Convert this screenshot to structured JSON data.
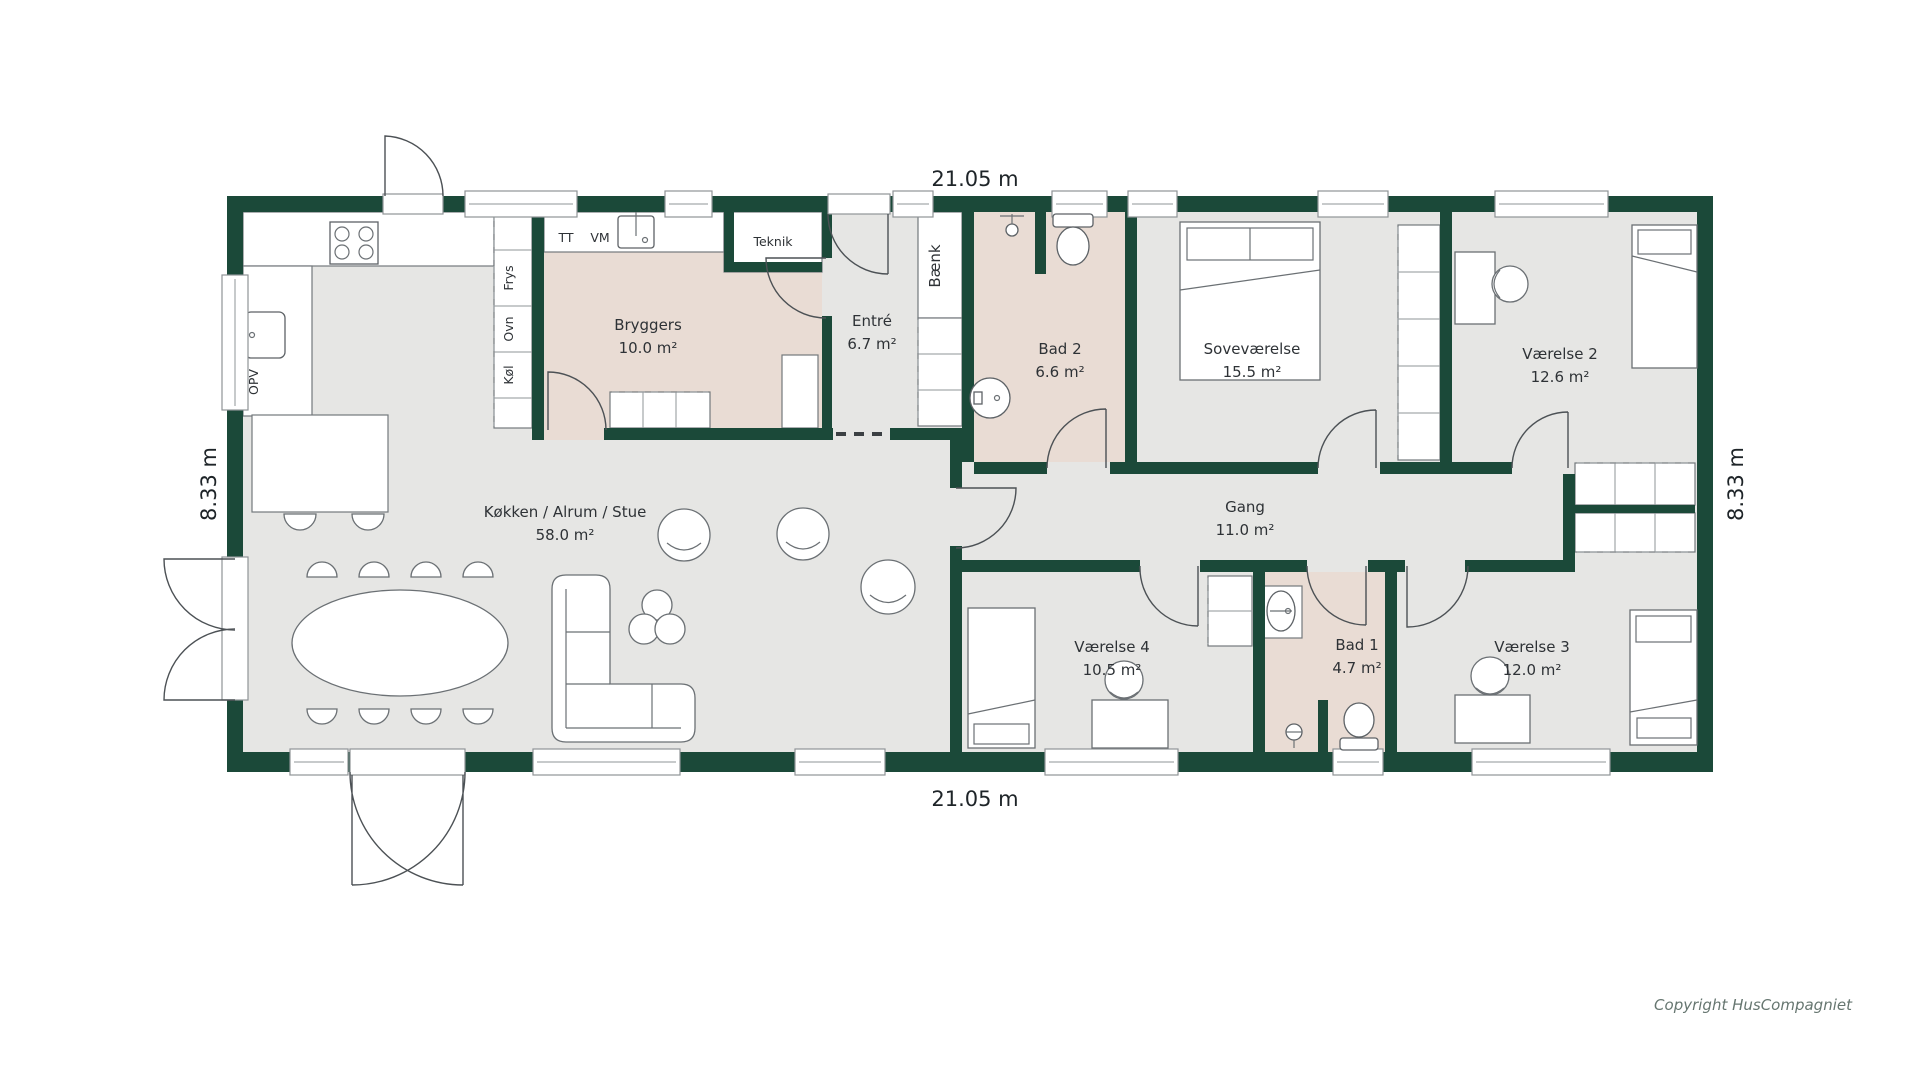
{
  "plan": {
    "dimensions": {
      "top": "21.05 m",
      "bottom": "21.05 m",
      "left": "8.33 m",
      "right": "8.33 m"
    },
    "rooms": [
      {
        "id": "bryggers",
        "name": "Bryggers",
        "area": "10.0 m²"
      },
      {
        "id": "entre",
        "name": "Entré",
        "area": "6.7 m²"
      },
      {
        "id": "bad2",
        "name": "Bad 2",
        "area": "6.6 m²"
      },
      {
        "id": "sovevaerelse",
        "name": "Soveværelse",
        "area": "15.5 m²"
      },
      {
        "id": "vaerelse2",
        "name": "Værelse 2",
        "area": "12.6 m²"
      },
      {
        "id": "stue",
        "name": "Køkken / Alrum / Stue",
        "area": "58.0 m²"
      },
      {
        "id": "gang",
        "name": "Gang",
        "area": "11.0 m²"
      },
      {
        "id": "vaerelse4",
        "name": "Værelse 4",
        "area": "10.5 m²"
      },
      {
        "id": "bad1",
        "name": "Bad 1",
        "area": "4.7 m²"
      },
      {
        "id": "vaerelse3",
        "name": "Værelse 3",
        "area": "12.0 m²"
      }
    ],
    "labels": {
      "tt": "TT",
      "vm": "VM",
      "teknik": "Teknik",
      "frys": "Frys",
      "ovn": "Ovn",
      "koel": "Køl",
      "opv": "OPV",
      "baenk": "Bænk"
    },
    "colors": {
      "wall": "#1b4939",
      "floor": "#e6e6e4",
      "wet_floor": "#e9dcd4"
    },
    "copyright": "Copyright HusCompagniet"
  }
}
